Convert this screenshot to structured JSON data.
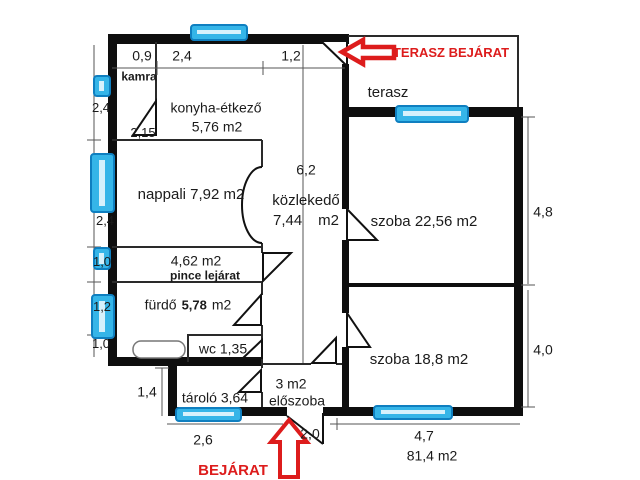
{
  "meta": {
    "drawing_type": "apartment floor plan",
    "total_area": "81,4 m2"
  },
  "colors": {
    "wall": "#0e0e0e",
    "thin_line": "#2a2a2a",
    "dim_line": "#555555",
    "window_fill": "#35b5e8",
    "window_inner": "#d6f1fc",
    "window_border": "#0f7fc0",
    "accent_red": "#dd1c1c"
  },
  "rooms": {
    "kamra": {
      "label": "kamra"
    },
    "konyha": {
      "label": "konyha-étkező",
      "area": "5,76 m2"
    },
    "nappali": {
      "label": "nappali 7,92 m2"
    },
    "kozlekedo": {
      "label": "közlekedő",
      "area": "7,44",
      "unit": "m2"
    },
    "terasz": {
      "label": "terasz"
    },
    "szoba_nagy": {
      "label": "szoba 22,56 m2"
    },
    "szoba_kis": {
      "label": "szoba 18,8 m2"
    },
    "pince": {
      "area": "4,62 m2",
      "label": "pince lejárat"
    },
    "furdo": {
      "label": "fürdő",
      "area": "5,78",
      "unit": "m2"
    },
    "wc": {
      "label": "wc 1,35"
    },
    "tarolo": {
      "label": "tároló 3,64"
    },
    "eloszoba": {
      "area": "3 m2",
      "label": "előszoba"
    }
  },
  "dimensions": {
    "top": {
      "d1": "0,9",
      "d2": "2,4",
      "d3": "1,2"
    },
    "left": {
      "d1": "2,4",
      "d2": "2,4",
      "d3": "1,0",
      "d4": "1,2",
      "d5": "1,0"
    },
    "inner": {
      "d1": "2,15",
      "d2": "6,2",
      "d3": "1,4"
    },
    "right": {
      "d1": "4,8",
      "d2": "4,0"
    },
    "bottom": {
      "d1": "2,6",
      "d2": "2,0",
      "d3": "4,7"
    },
    "total_area": "81,4 m2"
  },
  "annotations": {
    "terasz_entrance": "TERASZ BEJÁRAT",
    "entrance": "BEJÁRAT"
  }
}
